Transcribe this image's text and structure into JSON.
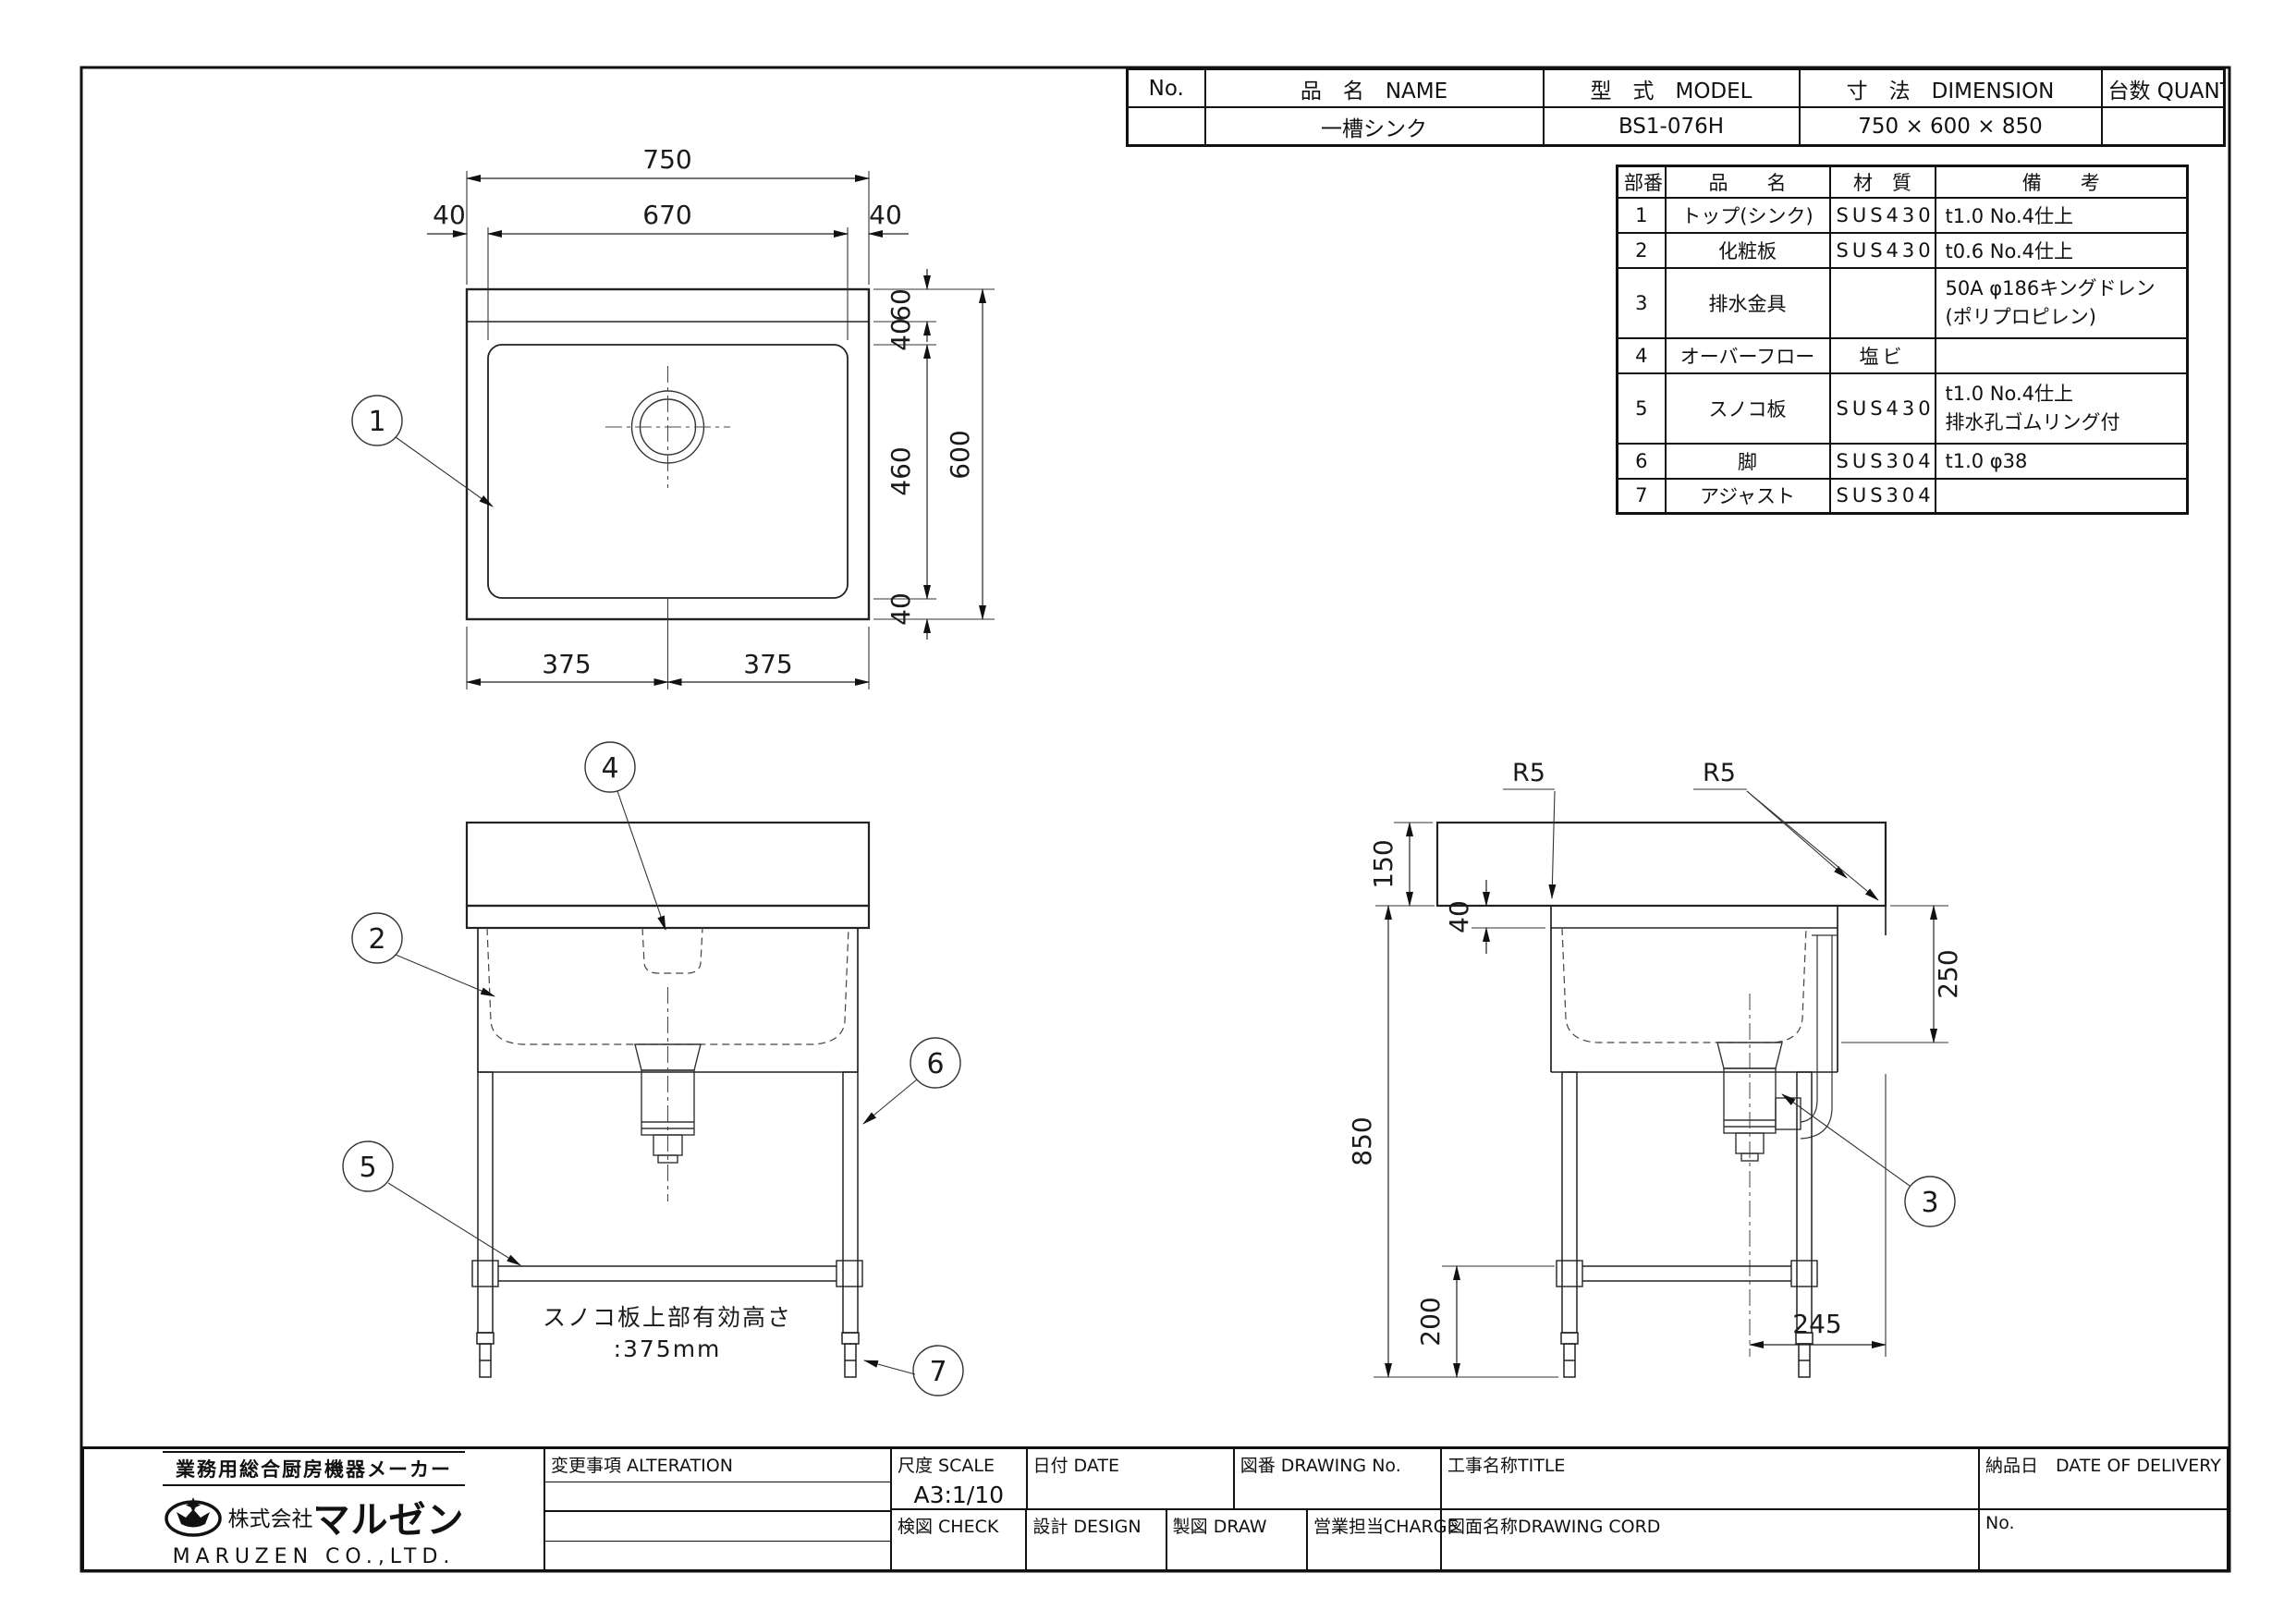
{
  "header_table": {
    "columns": {
      "no": "No.",
      "name": "品　名　NAME",
      "model": "型　式　MODEL",
      "dimension": "寸　法　DIMENSION",
      "quantity": "台数 QUANTITY"
    },
    "row": {
      "no": "",
      "name": "一槽シンク",
      "model": "BS1-076H",
      "dimension": "750 × 600 × 850",
      "quantity": ""
    }
  },
  "parts_table": {
    "headers": {
      "no": "部番",
      "name": "品　　名",
      "material": "材　質",
      "remark": "備　　考"
    },
    "rows": [
      {
        "no": "1",
        "name": "トップ(シンク)",
        "material": "SUS430",
        "remark": "t1.0 No.4仕上",
        "remark2": ""
      },
      {
        "no": "2",
        "name": "化粧板",
        "material": "SUS430",
        "remark": "t0.6 No.4仕上",
        "remark2": ""
      },
      {
        "no": "3",
        "name": "排水金具",
        "material": "",
        "remark": "50A φ186キングドレン",
        "remark2": "(ポリプロピレン)"
      },
      {
        "no": "4",
        "name": "オーバーフロー",
        "material": "塩ビ",
        "remark": "",
        "remark2": ""
      },
      {
        "no": "5",
        "name": "スノコ板",
        "material": "SUS430",
        "remark": "t1.0 No.4仕上",
        "remark2": "排水孔ゴムリング付"
      },
      {
        "no": "6",
        "name": "脚",
        "material": "SUS304",
        "remark": "t1.0 φ38",
        "remark2": ""
      },
      {
        "no": "7",
        "name": "アジャスト",
        "material": "SUS304",
        "remark": "",
        "remark2": ""
      }
    ]
  },
  "plan_view": {
    "dims": {
      "overall_w": "750",
      "edge_l": "40",
      "bowl_w": "670",
      "edge_r": "40",
      "back": "60",
      "gap_top": "40",
      "bowl_d": "460",
      "gap_bottom": "40",
      "overall_d": "600",
      "half_l": "375",
      "half_r": "375"
    },
    "callout_1": "1"
  },
  "front_view": {
    "callout_2": "2",
    "callout_4": "4",
    "callout_5": "5",
    "callout_6": "6",
    "callout_7": "7",
    "note_line1": "スノコ板上部有効高さ",
    "note_line2": ":375mm"
  },
  "side_view": {
    "dims": {
      "splash_h": "150",
      "top_t": "40",
      "height": "850",
      "shelf_h": "200",
      "bowl_depth": "250",
      "drain_offset": "245"
    },
    "r5_left": "R5",
    "r5_right": "R5",
    "callout_3": "3"
  },
  "title_block": {
    "maker_tagline": "業務用総合厨房機器メーカー",
    "company_prefix": "株式会社",
    "company_logo_text": "マルゼン",
    "company_en": "MARUZEN CO.,LTD.",
    "alteration_label": "変更事項  ALTERATION",
    "scale_label": "尺度 SCALE",
    "scale_value": "A3:1/10",
    "date_label": "日付 DATE",
    "drawing_no_label": "図番 DRAWING  No.",
    "check_label": "検図 CHECK",
    "design_label": "設計 DESIGN",
    "draw_label": "製図 DRAW",
    "charge_label": "営業担当CHARGE",
    "title_label": "工事名称TITLE",
    "delivery_label": "納品日　DATE  OF  DELIVERY",
    "drawing_name_label": "図面名称DRAWING  CORD",
    "no_label": "No."
  }
}
